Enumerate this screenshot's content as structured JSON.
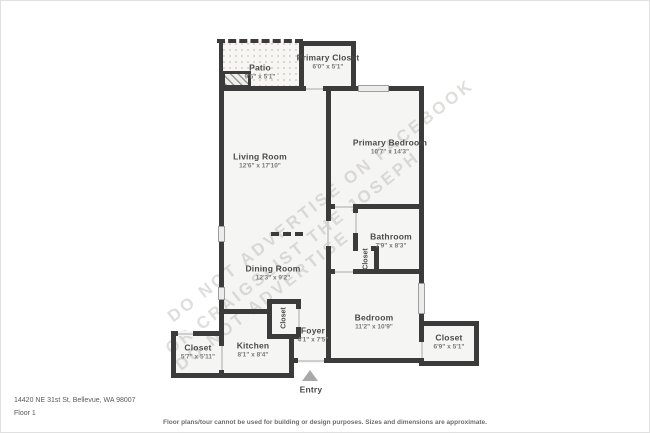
{
  "address": "14420 NE 31st St, Bellevue, WA 98007",
  "floor_label": "Floor 1",
  "disclaimer": "Floor plans/tour cannot be used for building or design purposes. Sizes and dimensions are approximate.",
  "entry_label": "Entry",
  "watermark": {
    "line1": "DO NOT ADVERTISE ON FACEBOOK",
    "line2": "OR CRAIGSLIST   THE JOSEPH",
    "line3": "DO NOT ADVERTISE"
  },
  "rooms": {
    "patio": {
      "name": "Patio",
      "dims": "9'5\" x 5'1\""
    },
    "primary_closet": {
      "name": "Primary Closet",
      "dims": "6'0\" x 5'1\""
    },
    "living_room": {
      "name": "Living Room",
      "dims": "12'6\" x 17'10\""
    },
    "primary_bedroom": {
      "name": "Primary Bedroom",
      "dims": "10'7\" x 14'3\""
    },
    "bathroom": {
      "name": "Bathroom",
      "dims": "7'9\" x 8'3\""
    },
    "bathroom_closet": {
      "name": "Closet"
    },
    "dining_room": {
      "name": "Dining Room",
      "dims": "12'3\" x 9'2\""
    },
    "bedroom": {
      "name": "Bedroom",
      "dims": "11'2\" x 10'9\""
    },
    "bedroom_closet": {
      "name": "Closet",
      "dims": "6'9\" x 5'1\""
    },
    "foyer": {
      "name": "Foyer",
      "dims": "4'1\" x 7'5\""
    },
    "foyer_closet": {
      "name": "Closet"
    },
    "kitchen": {
      "name": "Kitchen",
      "dims": "8'1\" x 8'4\""
    },
    "entry_closet": {
      "name": "Closet",
      "dims": "5'7\" x 5'11\""
    }
  },
  "colors": {
    "wall": "#3b3b3b",
    "room_fill": "#f5f5f4",
    "accent_text": "#4a4a4a"
  }
}
